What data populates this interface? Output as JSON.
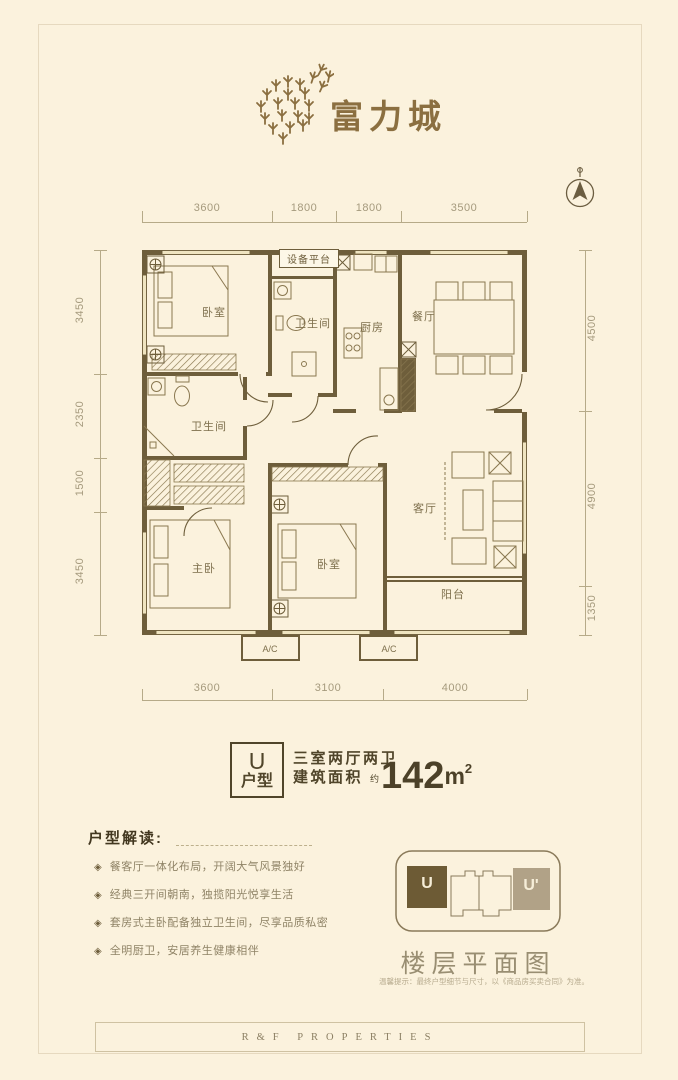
{
  "brand": {
    "name": "富力城"
  },
  "plan": {
    "dims_top": [
      "3600",
      "1800",
      "1800",
      "3500"
    ],
    "dims_left": [
      "3450",
      "2350",
      "1500",
      "3450"
    ],
    "dims_right": [
      "4500",
      "4900",
      "1350"
    ],
    "dims_bottom": [
      "3600",
      "3100",
      "4000"
    ],
    "rooms": {
      "bedroom_top": "卧室",
      "equipment_platform": "设备平台",
      "bathroom_top": "卫生间",
      "kitchen": "厨房",
      "dining": "餐厅",
      "bathroom_left": "卫生间",
      "master_bedroom": "主卧",
      "bedroom_mid": "卧室",
      "living_room": "客厅",
      "balcony": "阳台",
      "ac_left": "A/C",
      "ac_right": "A/C"
    }
  },
  "summary": {
    "unit_letter": "U",
    "unit_word": "户型",
    "layout_text": "三室两厅两卫",
    "area_label": "建筑面积",
    "area_prefix": "约",
    "area_number": "142",
    "area_unit": "m",
    "area_exponent": "2"
  },
  "interpretation": {
    "title": "户型解读:",
    "bullet_icon": "◈",
    "bullets": [
      "餐客厅一体化布局，开阔大气风景独好",
      "经典三开间朝南，独揽阳光悦享生活",
      "套房式主卧配备独立卫生间，尽享品质私密",
      "全明厨卫，安居养生健康相伴"
    ]
  },
  "mini_plan": {
    "left_unit": "U",
    "right_unit": "U'",
    "caption": "楼层平面图",
    "note": "温馨提示：最终户型细节与尺寸，以《商品房买卖合同》为准。"
  },
  "footer": {
    "text": "R&F PROPERTIES"
  }
}
